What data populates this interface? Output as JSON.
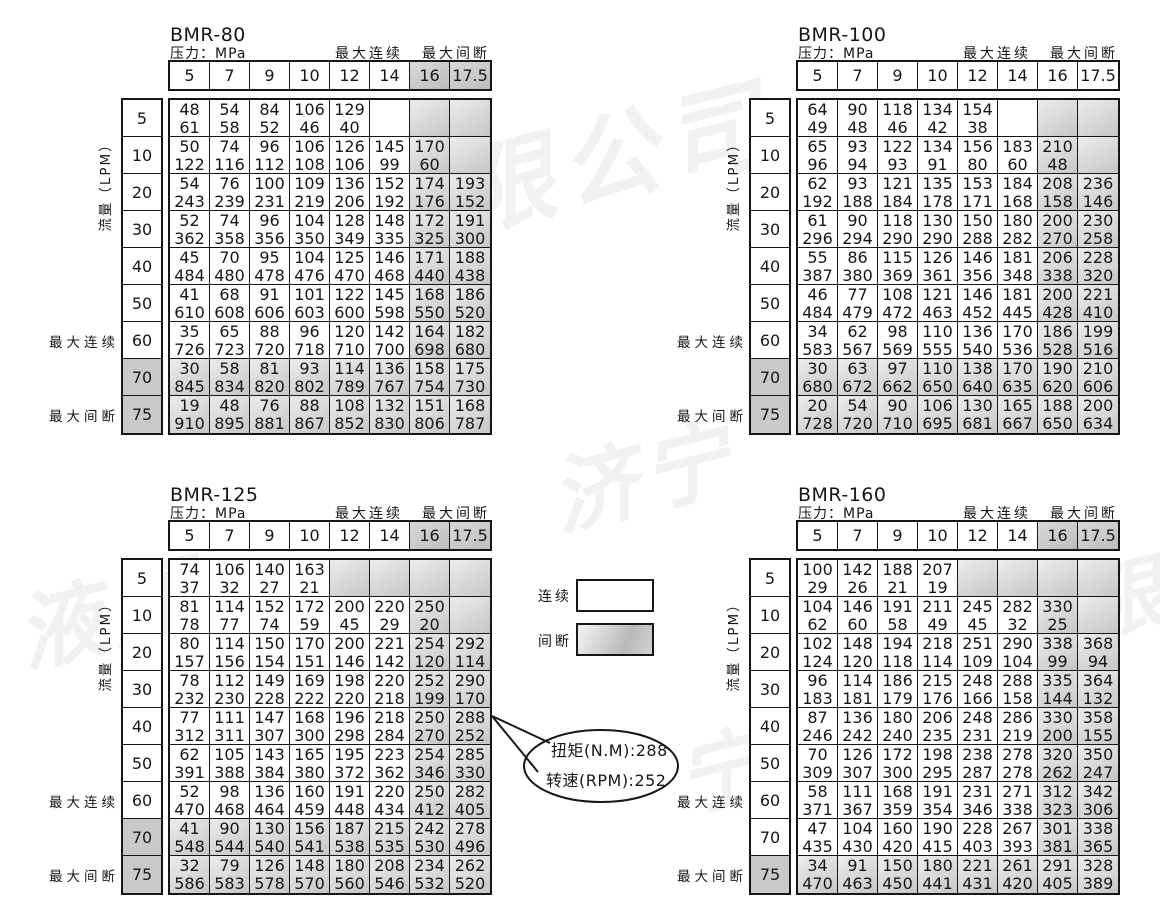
{
  "labels": {
    "pressure": "压力：MPa",
    "max_continuous": "最大连续",
    "max_intermittent": "最大间断",
    "flow": "流量（LPM）"
  },
  "pressure_headers": [
    "5",
    "7",
    "9",
    "10",
    "12",
    "14",
    "16",
    "17.5"
  ],
  "flow_rows": [
    "5",
    "10",
    "20",
    "30",
    "40",
    "50",
    "60",
    "70",
    "75"
  ],
  "legend": {
    "continuous_label": "连续",
    "intermittent_label": "间断"
  },
  "callout": {
    "line1": "扭矩(N.M):288",
    "line2": "转速(RPM):252"
  },
  "watermarks": [
    "限公司",
    "济宁",
    "液压",
    "宁",
    "有限"
  ],
  "tables": [
    {
      "title": "BMR-80",
      "shaded_header_cols": [
        6,
        7
      ],
      "shaded_cols": [
        6,
        7
      ],
      "shaded_rows": [
        7,
        8
      ],
      "shaded_label_rows": [
        7,
        8
      ],
      "extra_shaded_cells": [],
      "rows": [
        [
          "48|61",
          "54|58",
          "84|52",
          "106|46",
          "129|40",
          "",
          "",
          ""
        ],
        [
          "50|122",
          "74|116",
          "96|112",
          "106|108",
          "126|106",
          "145|99",
          "170|60",
          ""
        ],
        [
          "54|243",
          "76|239",
          "100|231",
          "109|219",
          "136|206",
          "152|192",
          "174|176",
          "193|152"
        ],
        [
          "52|362",
          "74|358",
          "96|356",
          "104|350",
          "128|349",
          "148|335",
          "172|325",
          "191|300"
        ],
        [
          "45|484",
          "70|480",
          "95|478",
          "104|476",
          "125|470",
          "146|468",
          "171|440",
          "188|438"
        ],
        [
          "41|610",
          "68|608",
          "91|606",
          "101|603",
          "122|600",
          "145|598",
          "168|550",
          "186|520"
        ],
        [
          "35|726",
          "65|723",
          "88|720",
          "96|718",
          "120|710",
          "142|700",
          "164|698",
          "182|680"
        ],
        [
          "30|845",
          "58|834",
          "81|820",
          "93|802",
          "114|789",
          "136|767",
          "158|754",
          "175|730"
        ],
        [
          "19|910",
          "48|895",
          "76|881",
          "88|867",
          "108|852",
          "132|830",
          "151|806",
          "168|787"
        ]
      ]
    },
    {
      "title": "BMR-100",
      "shaded_header_cols": [],
      "shaded_cols": [
        6,
        7
      ],
      "shaded_rows": [
        7,
        8
      ],
      "shaded_label_rows": [
        7,
        8
      ],
      "extra_shaded_cells": [],
      "rows": [
        [
          "64|49",
          "90|48",
          "118|46",
          "134|42",
          "154|38",
          "",
          "",
          ""
        ],
        [
          "65|96",
          "93|94",
          "122|93",
          "134|91",
          "156|80",
          "183|60",
          "210|48",
          ""
        ],
        [
          "62|192",
          "93|188",
          "121|184",
          "135|178",
          "153|171",
          "184|168",
          "208|158",
          "236|146"
        ],
        [
          "61|296",
          "90|294",
          "118|290",
          "130|290",
          "150|288",
          "180|282",
          "200|270",
          "230|258"
        ],
        [
          "55|387",
          "86|380",
          "115|369",
          "126|361",
          "146|356",
          "181|348",
          "206|338",
          "228|320"
        ],
        [
          "46|484",
          "77|479",
          "108|472",
          "121|463",
          "146|452",
          "181|445",
          "200|428",
          "221|410"
        ],
        [
          "34|583",
          "62|567",
          "98|569",
          "110|555",
          "136|540",
          "170|536",
          "186|528",
          "199|516"
        ],
        [
          "30|680",
          "63|672",
          "97|662",
          "110|650",
          "138|640",
          "170|635",
          "190|620",
          "210|606"
        ],
        [
          "20|728",
          "54|720",
          "90|710",
          "106|695",
          "130|681",
          "165|667",
          "188|650",
          "200|634"
        ]
      ]
    },
    {
      "title": "BMR-125",
      "shaded_header_cols": [
        6,
        7
      ],
      "shaded_cols": [
        6,
        7
      ],
      "shaded_rows": [
        7,
        8
      ],
      "shaded_label_rows": [
        7,
        8
      ],
      "extra_shaded_cells": [
        [
          0,
          4
        ],
        [
          0,
          5
        ]
      ],
      "rows": [
        [
          "74|37",
          "106|32",
          "140|27",
          "163|21",
          "",
          "",
          "",
          ""
        ],
        [
          "81|78",
          "114|77",
          "152|74",
          "172|59",
          "200|45",
          "220|29",
          "250|20",
          ""
        ],
        [
          "80|157",
          "114|156",
          "150|154",
          "170|151",
          "200|146",
          "221|142",
          "254|120",
          "292|114"
        ],
        [
          "78|232",
          "112|230",
          "149|228",
          "169|222",
          "198|220",
          "220|218",
          "252|199",
          "290|170"
        ],
        [
          "77|312",
          "111|311",
          "147|307",
          "168|300",
          "196|298",
          "218|284",
          "250|270",
          "288|252"
        ],
        [
          "62|391",
          "105|388",
          "143|384",
          "165|380",
          "195|372",
          "223|362",
          "254|346",
          "285|330"
        ],
        [
          "52|470",
          "98|468",
          "136|464",
          "160|459",
          "191|448",
          "220|434",
          "250|412",
          "282|405"
        ],
        [
          "41|548",
          "90|544",
          "130|540",
          "156|541",
          "187|538",
          "215|535",
          "242|530",
          "278|496"
        ],
        [
          "32|586",
          "79|583",
          "126|578",
          "148|570",
          "180|560",
          "208|546",
          "234|532",
          "262|520"
        ]
      ]
    },
    {
      "title": "BMR-160",
      "shaded_header_cols": [
        6,
        7
      ],
      "shaded_cols": [
        6,
        7
      ],
      "shaded_rows": [
        8
      ],
      "shaded_label_rows": [
        8
      ],
      "extra_shaded_cells": [
        [
          0,
          4
        ],
        [
          0,
          5
        ]
      ],
      "rows": [
        [
          "100|29",
          "142|26",
          "188|21",
          "207|19",
          "",
          "",
          "",
          ""
        ],
        [
          "104|62",
          "146|60",
          "191|58",
          "211|49",
          "245|45",
          "282|32",
          "330|25",
          ""
        ],
        [
          "102|124",
          "148|120",
          "194|118",
          "218|114",
          "251|109",
          "290|104",
          "338|99",
          "368|94"
        ],
        [
          "96|183",
          "114|181",
          "186|179",
          "215|176",
          "248|166",
          "288|158",
          "335|144",
          "364|132"
        ],
        [
          "87|246",
          "136|242",
          "180|240",
          "206|235",
          "248|231",
          "286|219",
          "330|200",
          "358|155"
        ],
        [
          "70|309",
          "126|307",
          "172|300",
          "198|295",
          "238|287",
          "278|278",
          "320|262",
          "350|247"
        ],
        [
          "58|371",
          "111|367",
          "168|359",
          "191|354",
          "231|346",
          "271|338",
          "312|323",
          "342|306"
        ],
        [
          "47|435",
          "104|430",
          "160|420",
          "190|415",
          "228|403",
          "267|393",
          "301|381",
          "338|365"
        ],
        [
          "34|470",
          "91|463",
          "150|450",
          "180|441",
          "221|431",
          "261|420",
          "291|405",
          "328|389"
        ]
      ]
    }
  ]
}
